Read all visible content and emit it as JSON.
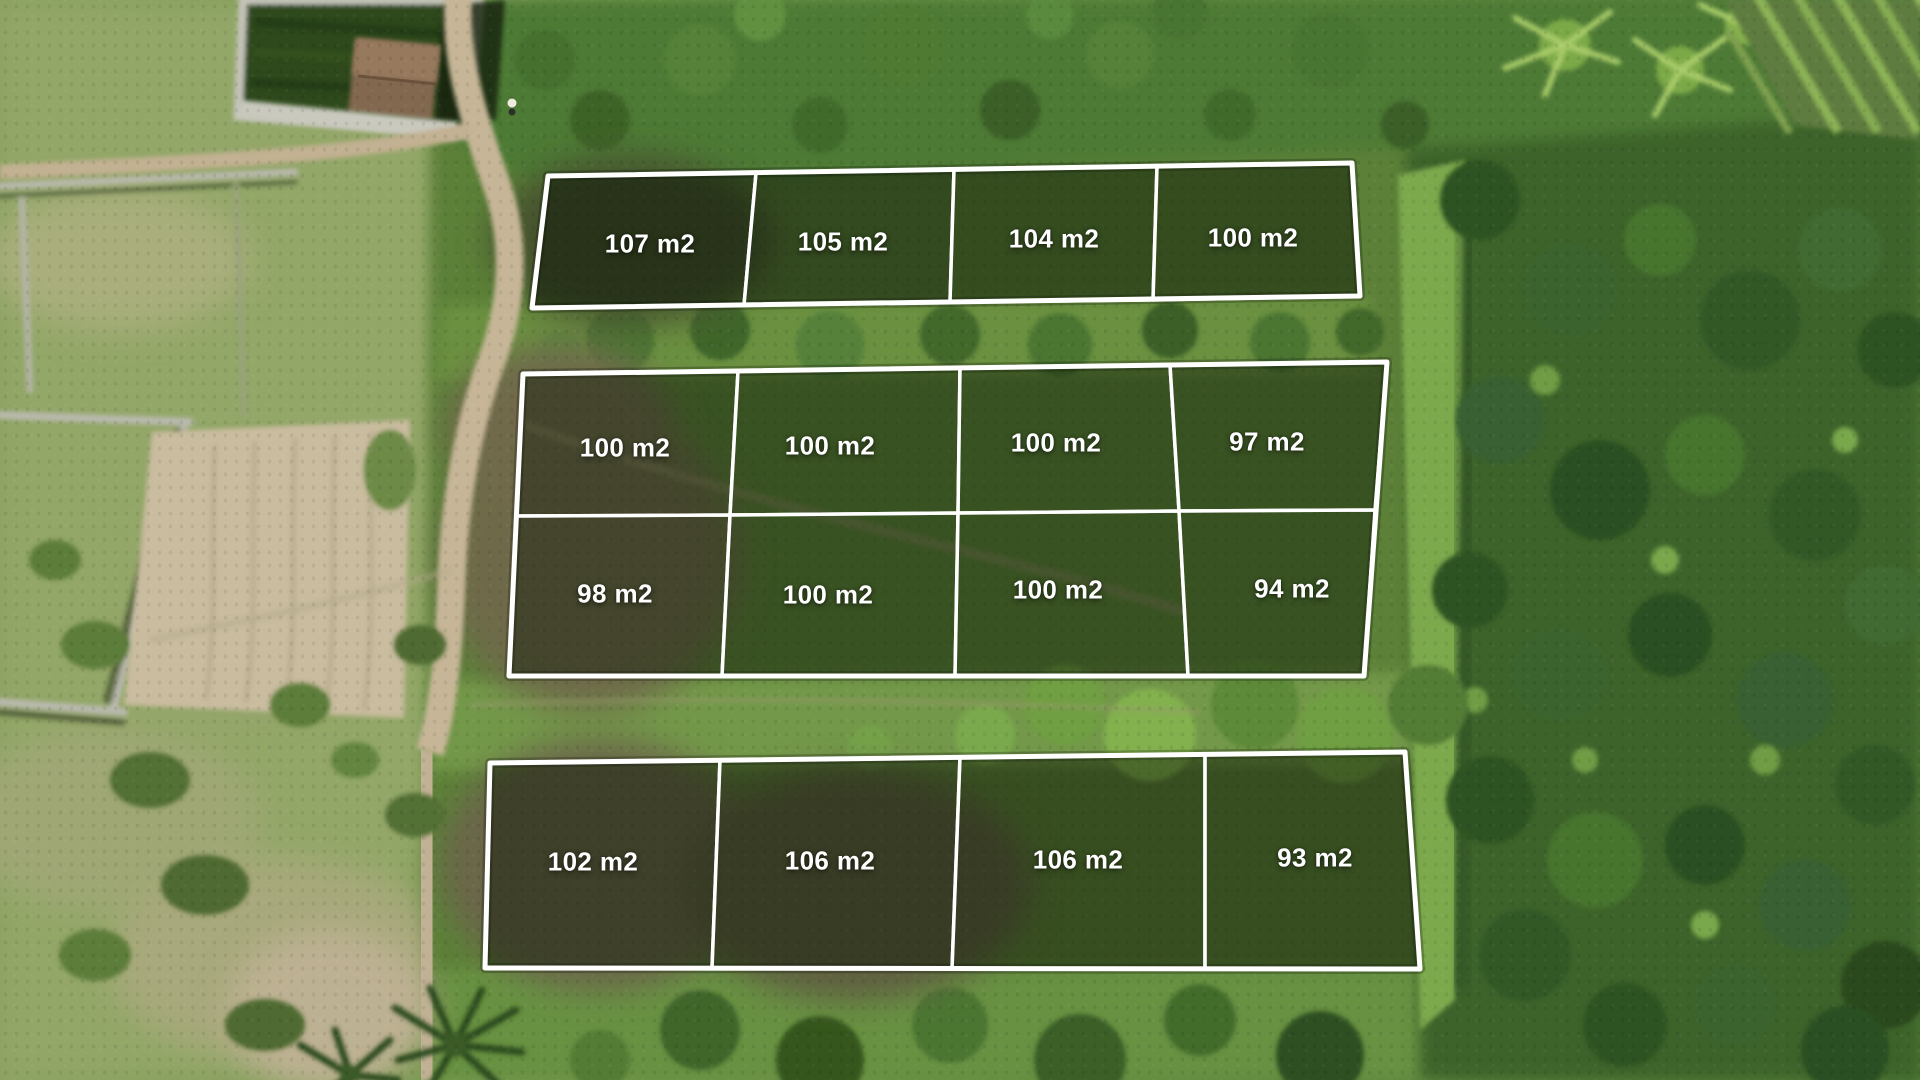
{
  "colors": {
    "plot_boundary": "#ffffff",
    "plot_label_text": "#ffffff"
  },
  "plot_labels": {
    "row1": [
      "107 m2",
      "105 m2",
      "104 m2",
      "100 m2"
    ],
    "row2": [
      "100 m2",
      "100 m2",
      "100 m2",
      "97 m2"
    ],
    "row3": [
      "98 m2",
      "100 m2",
      "100 m2",
      "94 m2"
    ],
    "row4": [
      "102 m2",
      "106 m2",
      "106 m2",
      "93 m2"
    ]
  }
}
